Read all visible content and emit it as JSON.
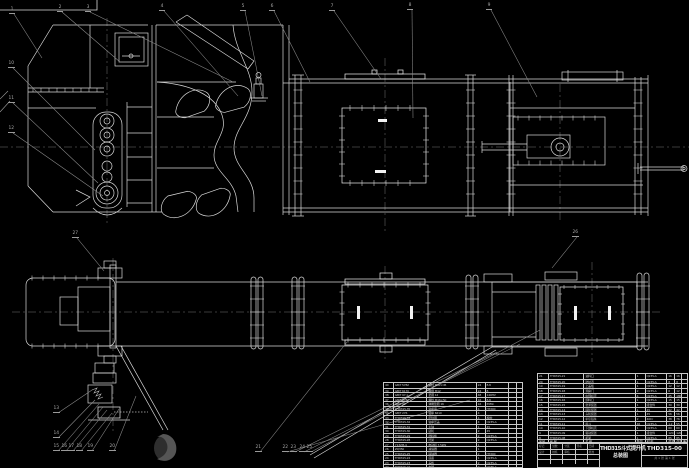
{
  "colors": {
    "background": "#000000",
    "line": "#d9d9d9",
    "bright": "#ffffff",
    "leader": "#8c8c8c",
    "table_grid": "#c9c9c9",
    "text": "#c6c6c6",
    "watermark": "#4a4a4a"
  },
  "title_block": {
    "product_title": "THD315斗式提升机",
    "drawing_title": "总装图",
    "drawing_number": "THD315-00",
    "sheet_info": "共 1 张  第 1 张",
    "left_labels": [
      "标记",
      "处数",
      "分区",
      "签名",
      "日期"
    ],
    "sign_labels": [
      "设计",
      "校核",
      "审核",
      "",
      "批准"
    ]
  },
  "bom_right": {
    "headers": [
      "序号",
      "代  号",
      "名  称",
      "数量",
      "材  料",
      "单重",
      "总重",
      "备注"
    ],
    "rows": [
      [
        "21",
        "THD315-21",
        "进料口",
        "1",
        "Q235-A",
        "16",
        "16",
        ""
      ],
      [
        "20",
        "THD315-20",
        "防护罩",
        "1",
        "Q235-A",
        "8",
        "8",
        ""
      ],
      [
        "19",
        "THD315-19",
        "上盖板",
        "1",
        "Q235-A",
        "12",
        "12",
        ""
      ],
      [
        "18",
        "THD315-18",
        "观察门",
        "2",
        "Q235-A",
        "6",
        "12",
        ""
      ],
      [
        "17",
        "THD315-17",
        "中部机壳",
        "4",
        "Q235-A",
        "45",
        "180",
        ""
      ],
      [
        "16",
        "THD315-16",
        "卸料口",
        "1",
        "Q235-A",
        "15",
        "15",
        ""
      ],
      [
        "15",
        "THD315-15",
        "张紧装置",
        "1",
        "组合件",
        "30",
        "30",
        ""
      ],
      [
        "14",
        "THD315-14",
        "尾轮装置",
        "1",
        "45",
        "42",
        "42",
        ""
      ],
      [
        "13",
        "THD315-13",
        "头轮装置",
        "1",
        "45",
        "56",
        "56",
        ""
      ],
      [
        "12",
        "THD315-12",
        "牵引链条",
        "2",
        "40Cr",
        "38",
        "76",
        ""
      ],
      [
        "11",
        "THD315-11",
        "料斗",
        "46",
        "Q235-A",
        "1.2",
        "55",
        ""
      ],
      [
        "10",
        "THD315-10",
        "下部机壳",
        "1",
        "Q235-A",
        "60",
        "60",
        ""
      ],
      [
        "9",
        "THD315-09",
        "驱动装置",
        "1",
        "组合件",
        "120",
        "120",
        ""
      ],
      [
        "8",
        "THD315-08",
        "机架",
        "1",
        "Q235-A",
        "85",
        "85",
        ""
      ]
    ]
  },
  "bom_left": {
    "rows": [
      [
        "40",
        "GB/T 5782",
        "螺栓 M12×45",
        "24",
        "8.8",
        "",
        ""
      ],
      [
        "39",
        "GB/T 6170",
        "螺母 M12",
        "24",
        "8",
        "",
        ""
      ],
      [
        "38",
        "GB/T 97.1",
        "垫圈 12",
        "48",
        "140HV",
        "",
        ""
      ],
      [
        "37",
        "GB/T 5782",
        "螺栓 M16×50",
        "16",
        "8.8",
        "",
        ""
      ],
      [
        "36",
        "GB/T 93",
        "弹簧垫圈 16",
        "16",
        "65Mn",
        "",
        ""
      ],
      [
        "35",
        "THD315-35",
        "轴承座",
        "4",
        "HT200",
        "",
        ""
      ],
      [
        "34",
        "GB/T 276",
        "轴承 6210",
        "4",
        "",
        "",
        ""
      ],
      [
        "33",
        "THD315-33",
        "密封圈",
        "4",
        "橡胶",
        "",
        ""
      ],
      [
        "32",
        "THD315-32",
        "轴承压盖",
        "4",
        "Q235-A",
        "",
        ""
      ],
      [
        "31",
        "THD315-31",
        "主轴",
        "1",
        "45",
        "",
        ""
      ],
      [
        "30",
        "THD315-30",
        "链轮",
        "2",
        "45",
        "",
        ""
      ],
      [
        "29",
        "THD315-29",
        "挡料板",
        "2",
        "Q235-A",
        "",
        ""
      ],
      [
        "28",
        "THD315-28",
        "托架",
        "2",
        "Q235-A",
        "",
        ""
      ],
      [
        "27",
        "Y132M-4",
        "电动机 7.5kW",
        "1",
        "",
        "",
        ""
      ],
      [
        "26",
        "ZQ350",
        "减速器",
        "1",
        "",
        "",
        ""
      ],
      [
        "25",
        "THD315-25",
        "联轴器",
        "2",
        "HT200",
        "",
        ""
      ],
      [
        "24",
        "THD315-24",
        "底座",
        "1",
        "Q235-A",
        "",
        ""
      ],
      [
        "23",
        "THD315-23",
        "盖板",
        "2",
        "Q235-A",
        "",
        ""
      ],
      [
        "22",
        "THD315-22",
        "支腿",
        "2",
        "Q235-A",
        "",
        ""
      ]
    ]
  },
  "callouts": [
    {
      "n": "1",
      "x": 11,
      "y": 12,
      "tx": 42,
      "ty": 58
    },
    {
      "n": "2",
      "x": 59,
      "y": 10,
      "tx": 120,
      "ty": 62
    },
    {
      "n": "3",
      "x": 87,
      "y": 10,
      "tx": 233,
      "ty": 82
    },
    {
      "n": "4",
      "x": 161,
      "y": 9,
      "tx": 238,
      "ty": 96
    },
    {
      "n": "5",
      "x": 242,
      "y": 9,
      "tx": 262,
      "ty": 96
    },
    {
      "n": "6",
      "x": 271,
      "y": 9,
      "tx": 310,
      "ty": 82
    },
    {
      "n": "7",
      "x": 331,
      "y": 9,
      "tx": 381,
      "ty": 79
    },
    {
      "n": "8",
      "x": 409,
      "y": 8,
      "tx": 413,
      "ty": 118
    },
    {
      "n": "9",
      "x": 488,
      "y": 8,
      "tx": 537,
      "ty": 97
    },
    {
      "n": "10",
      "x": 10,
      "y": 66,
      "tx": 95,
      "ty": 150
    },
    {
      "n": "11",
      "x": 10,
      "y": 101,
      "tx": 98,
      "ty": 183
    },
    {
      "n": "12",
      "x": 10,
      "y": 131,
      "tx": 103,
      "ty": 196
    },
    {
      "n": "13",
      "x": 55,
      "y": 411,
      "tx": 92,
      "ty": 390
    },
    {
      "n": "14",
      "x": 55,
      "y": 436,
      "tx": 95,
      "ty": 400
    },
    {
      "n": "15",
      "x": 55,
      "y": 449,
      "tx": 99,
      "ty": 404
    },
    {
      "n": "16",
      "x": 63,
      "y": 449,
      "tx": 103,
      "ty": 407
    },
    {
      "n": "17",
      "x": 70,
      "y": 449,
      "tx": 107,
      "ty": 410
    },
    {
      "n": "18",
      "x": 78,
      "y": 449,
      "tx": 112,
      "ty": 413
    },
    {
      "n": "19",
      "x": 89,
      "y": 449,
      "tx": 119,
      "ty": 409
    },
    {
      "n": "20",
      "x": 111,
      "y": 449,
      "tx": 136,
      "ty": 396
    },
    {
      "n": "21",
      "x": 257,
      "y": 450,
      "tx": 347,
      "ty": 342
    },
    {
      "n": "22",
      "x": 284,
      "y": 450,
      "tx": 470,
      "ty": 400
    },
    {
      "n": "23",
      "x": 292,
      "y": 450,
      "tx": 497,
      "ty": 352
    },
    {
      "n": "24",
      "x": 301,
      "y": 450,
      "tx": 520,
      "ty": 344
    },
    {
      "n": "25",
      "x": 308,
      "y": 450,
      "tx": 540,
      "ty": 330
    },
    {
      "n": "26",
      "x": 574,
      "y": 235,
      "tx": 552,
      "ty": 268
    },
    {
      "n": "27",
      "x": 74,
      "y": 236,
      "tx": 104,
      "ty": 271
    }
  ]
}
